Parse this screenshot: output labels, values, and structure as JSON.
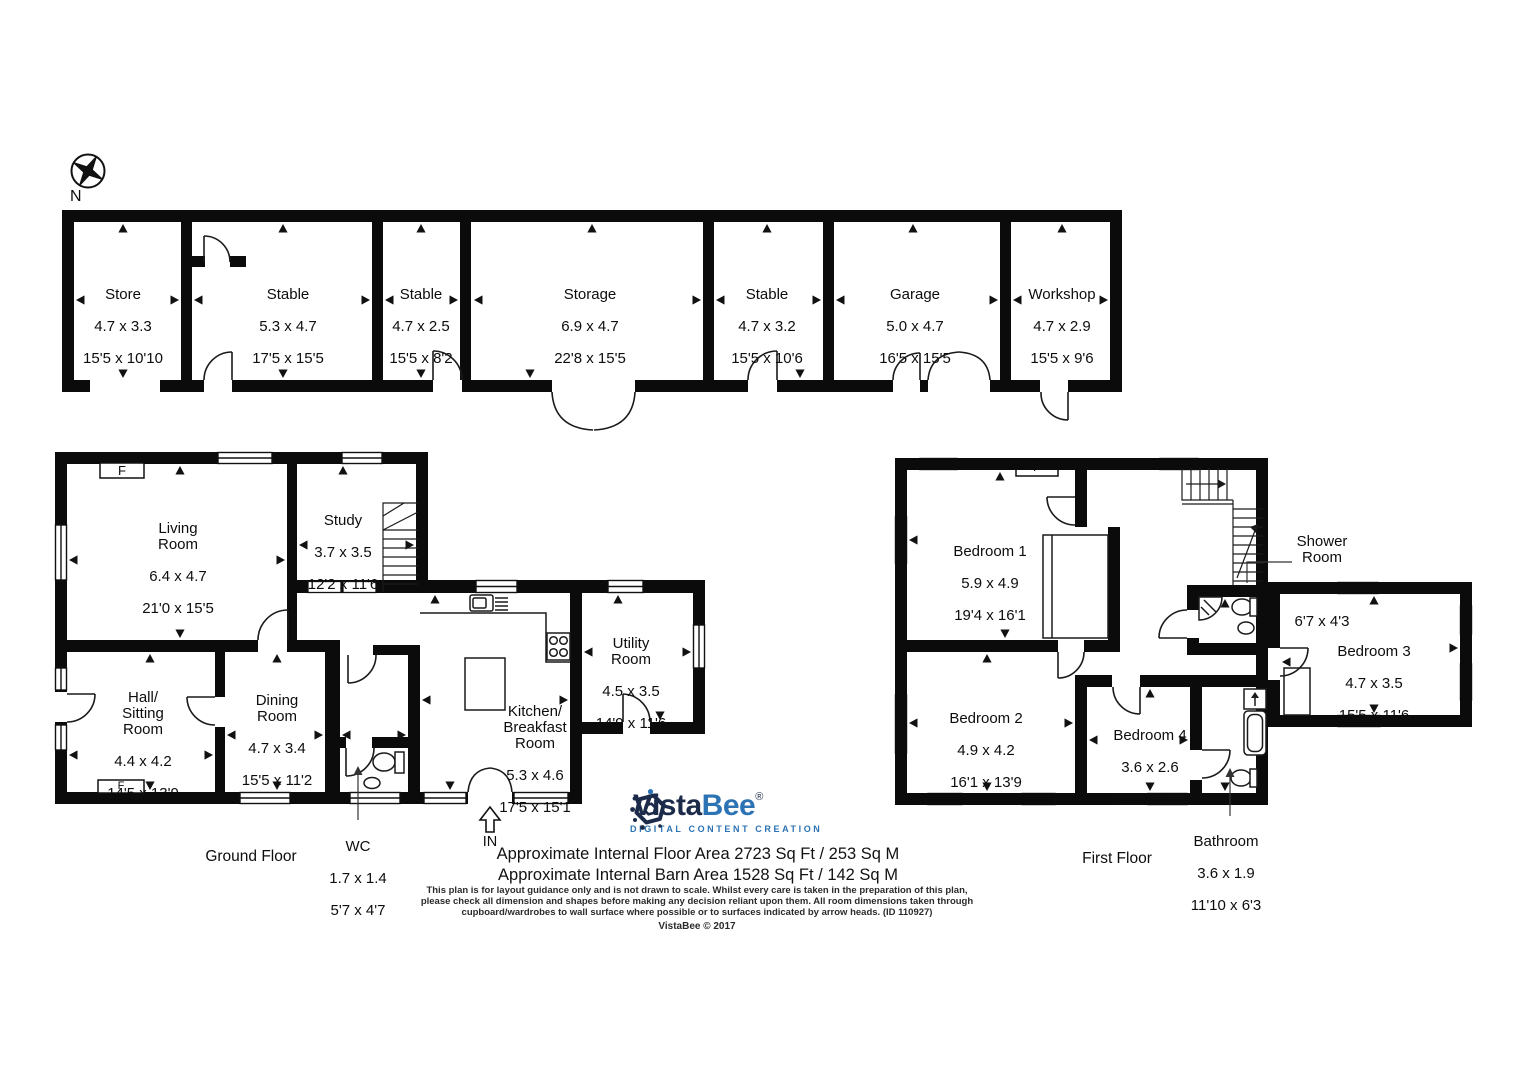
{
  "compass": {
    "north_label": "N"
  },
  "fireplace_label": "F",
  "entrance_label": "IN",
  "floors": {
    "barn": {
      "rooms": [
        {
          "name": "Store",
          "metric": "4.7 x 3.3",
          "imperial": "15'5 x 10'10"
        },
        {
          "name": "Stable",
          "metric": "5.3 x 4.7",
          "imperial": "17'5 x 15'5"
        },
        {
          "name": "Stable",
          "metric": "4.7 x 2.5",
          "imperial": "15'5 x 8'2"
        },
        {
          "name": "Storage",
          "metric": "6.9 x 4.7",
          "imperial": "22'8 x 15'5"
        },
        {
          "name": "Stable",
          "metric": "4.7 x 3.2",
          "imperial": "15'5 x 10'6"
        },
        {
          "name": "Garage",
          "metric": "5.0 x 4.7",
          "imperial": "16'5 x 15'5"
        },
        {
          "name": "Workshop",
          "metric": "4.7 x 2.9",
          "imperial": "15'5 x 9'6"
        }
      ]
    },
    "ground": {
      "label": "Ground Floor",
      "rooms": [
        {
          "name": "Living\nRoom",
          "metric": "6.4 x 4.7",
          "imperial": "21'0 x 15'5"
        },
        {
          "name": "Study",
          "metric": "3.7 x 3.5",
          "imperial": "12'2 x 11'6"
        },
        {
          "name": "Hall/\nSitting\nRoom",
          "metric": "4.4 x 4.2",
          "imperial": "14'5 x 13'9"
        },
        {
          "name": "Dining\nRoom",
          "metric": "4.7 x 3.4",
          "imperial": "15'5 x 11'2"
        },
        {
          "name": "Kitchen/\nBreakfast\nRoom",
          "metric": "5.3 x 4.6",
          "imperial": "17'5 x 15'1"
        },
        {
          "name": "Utility\nRoom",
          "metric": "4.5 x 3.5",
          "imperial": "14'9 x 11'6"
        },
        {
          "name": "WC",
          "metric": "1.7 x 1.4",
          "imperial": "5'7 x 4'7"
        }
      ]
    },
    "first": {
      "label": "First Floor",
      "rooms": [
        {
          "name": "Bedroom 1",
          "metric": "5.9 x 4.9",
          "imperial": "19'4 x 16'1"
        },
        {
          "name": "Shower\nRoom",
          "metric": "2.0 x 1.3",
          "imperial": "6'7 x 4'3"
        },
        {
          "name": "Bedroom 3",
          "metric": "4.7 x 3.5",
          "imperial": "15'5 x 11'6"
        },
        {
          "name": "Bedroom 2",
          "metric": "4.9 x 4.2",
          "imperial": "16'1 x 13'9"
        },
        {
          "name": "Bedroom 4",
          "metric": "3.6 x 2.6",
          "imperial": "11'10 x 8'6"
        },
        {
          "name": "Bathroom",
          "metric": "3.6 x 1.9",
          "imperial": "11'10 x 6'3"
        }
      ]
    }
  },
  "logo": {
    "vista": "Vista",
    "bee": "Bee",
    "reg": "®",
    "tagline": "DIGITAL CONTENT CREATION",
    "navy": "#1c2b4a",
    "blue": "#2c73b5"
  },
  "footer": {
    "floor_area_line": "Approximate Internal Floor Area 2723 Sq Ft / 253 Sq M",
    "barn_area_line": "Approximate Internal Barn Area 1528 Sq Ft / 142 Sq M",
    "disclaimer": "This plan is for layout guidance only and is not drawn to scale. Whilst every care is taken in the preparation of this plan,\nplease check all dimension and shapes before making any decision reliant upon them. All room dimensions taken through\ncupboard/wardrobes to wall surface where possible or to surfaces indicated by arrow heads. (ID 110927)",
    "copyright": "VistaBee © 2017"
  }
}
